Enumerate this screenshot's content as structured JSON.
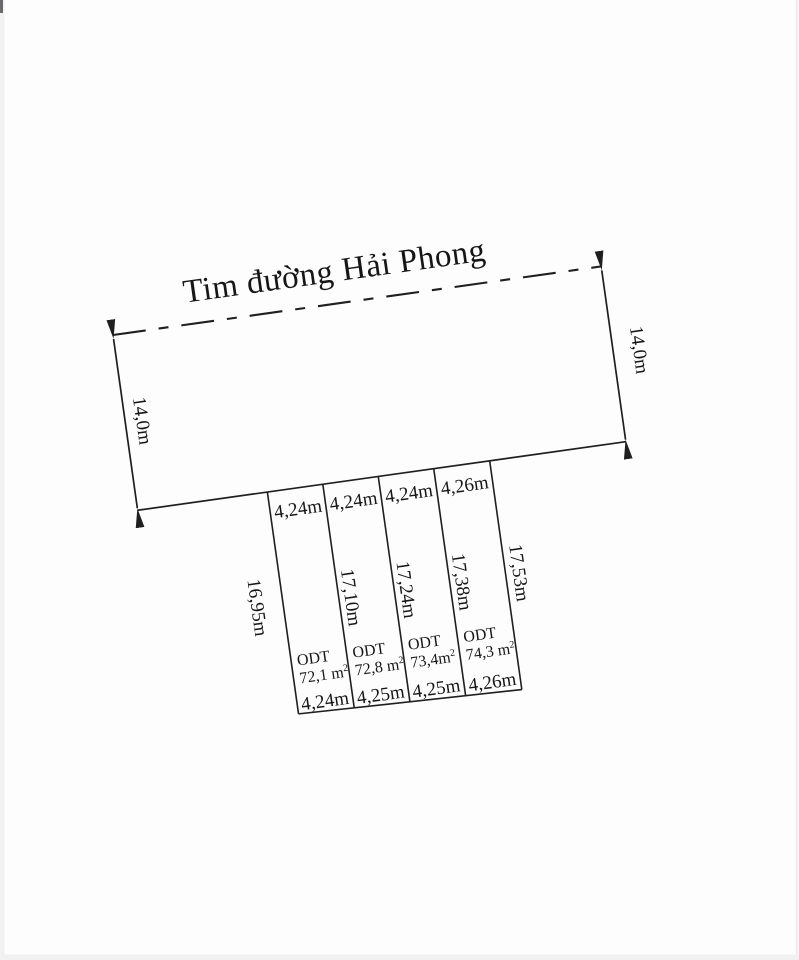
{
  "colors": {
    "ink": "#1f1f1f",
    "paper": "#fdfdfd",
    "scan_edge": "#f0f0f0"
  },
  "survey": {
    "road_centerline_label": "Tim đường Hải Phong",
    "road_depth_left": "14,0m",
    "road_depth_right": "14,0m",
    "side_labels": [
      "16,95m",
      "17,10m",
      "17,24m",
      "17,38m",
      "17,53m"
    ],
    "plots": [
      {
        "top_width": "4,24m",
        "left_side": "16,95m",
        "right_side": "17,10m",
        "land_use": "ODT",
        "area": "72,1 m",
        "area_superscript": "2",
        "bottom_width": "4,24m"
      },
      {
        "top_width": "4,24m",
        "left_side": "17,10m",
        "right_side": "17,24m",
        "land_use": "ODT",
        "area": "72,8 m",
        "area_superscript": "2",
        "bottom_width": "4,25m"
      },
      {
        "top_width": "4,24m",
        "left_side": "17,24m",
        "right_side": "17,38m",
        "land_use": "ODT",
        "area": "73,4m",
        "area_superscript": "2",
        "bottom_width": "4,25m"
      },
      {
        "top_width": "4,26m",
        "left_side": "17,38m",
        "right_side": "17,53m",
        "land_use": "ODT",
        "area": "74,3 m",
        "area_superscript": "2",
        "bottom_width": "4,26m"
      }
    ]
  }
}
